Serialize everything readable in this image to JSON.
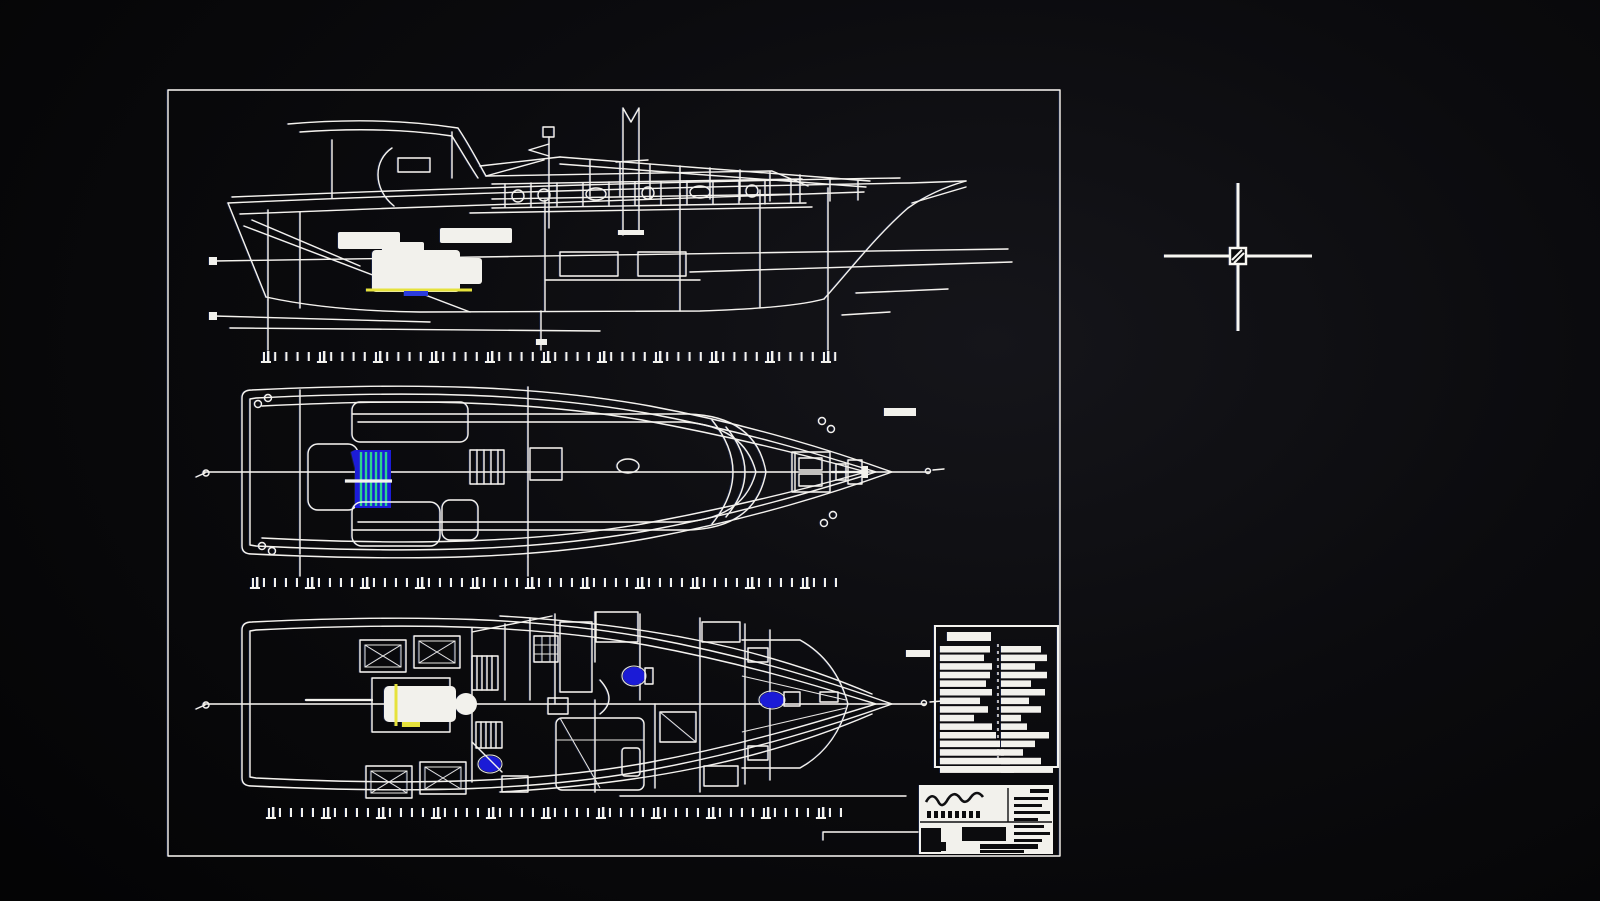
{
  "viewport": {
    "type": "cad-drawing-viewport",
    "description": "dark CAD canvas showing a motor-yacht general arrangement drawing sheet and a crosshair cursor",
    "background_color": "#0b0b0e"
  },
  "colors": {
    "line": "#f4f3ee",
    "paper": "#f2f1ec",
    "accent_blue": "#1c1cd8",
    "accent_green": "#2bd48e",
    "accent_cyan": "#3ae0cc",
    "accent_yellow": "#e6e23c",
    "cursor": "#f8f7f2"
  },
  "sheet": {
    "x": 168,
    "y": 90,
    "width": 892,
    "height": 766,
    "border_width": 2.4
  },
  "views": [
    {
      "id": "profile-view",
      "kind": "side elevation of hull, superstructure, mast and engine"
    },
    {
      "id": "deck-plan-view",
      "kind": "deck plan with cockpit furniture, companionway stairs, windlass and anchor"
    },
    {
      "id": "arrangement-view",
      "kind": "interior arrangement plan with hatches, engine, berths and heads"
    }
  ],
  "tick_rows": [
    {
      "x": 263,
      "y": 352,
      "count": 52,
      "spacing": 11.2,
      "h": 9
    },
    {
      "x": 252,
      "y": 578,
      "count": 54,
      "spacing": 11.0,
      "h": 9
    },
    {
      "x": 268,
      "y": 808,
      "count": 53,
      "spacing": 11.0,
      "h": 9
    }
  ],
  "spec_table": {
    "x": 935,
    "y": 626,
    "width": 123,
    "height": 141,
    "header_bar": {
      "x": 947,
      "y": 632,
      "w": 44,
      "h": 9
    },
    "divider_x": 998,
    "row_h": 8,
    "rows": [
      {
        "l": 50,
        "r": 40
      },
      {
        "l": 44,
        "r": 46
      },
      {
        "l": 52,
        "r": 34
      },
      {
        "l": 50,
        "r": 46
      },
      {
        "l": 46,
        "r": 30
      },
      {
        "l": 52,
        "r": 44
      },
      {
        "l": 40,
        "r": 28
      },
      {
        "l": 48,
        "r": 40
      },
      {
        "l": 34,
        "r": 20
      },
      {
        "l": 52,
        "r": 26
      },
      {
        "l": 56,
        "r": 48
      },
      {
        "l": 60,
        "r": 34
      },
      {
        "l": 64,
        "r": 22
      },
      {
        "l": 70,
        "r": 40
      },
      {
        "l": 74,
        "r": 52
      }
    ]
  },
  "title_block": {
    "x": 920,
    "y": 786,
    "width": 132,
    "height": 67,
    "legible": false
  },
  "crosshair": {
    "cx": 1238,
    "cy": 256,
    "h_from": 1164,
    "h_to": 1312,
    "v_from": 183,
    "v_to": 331,
    "pickbox": 16,
    "line_width": 3
  }
}
